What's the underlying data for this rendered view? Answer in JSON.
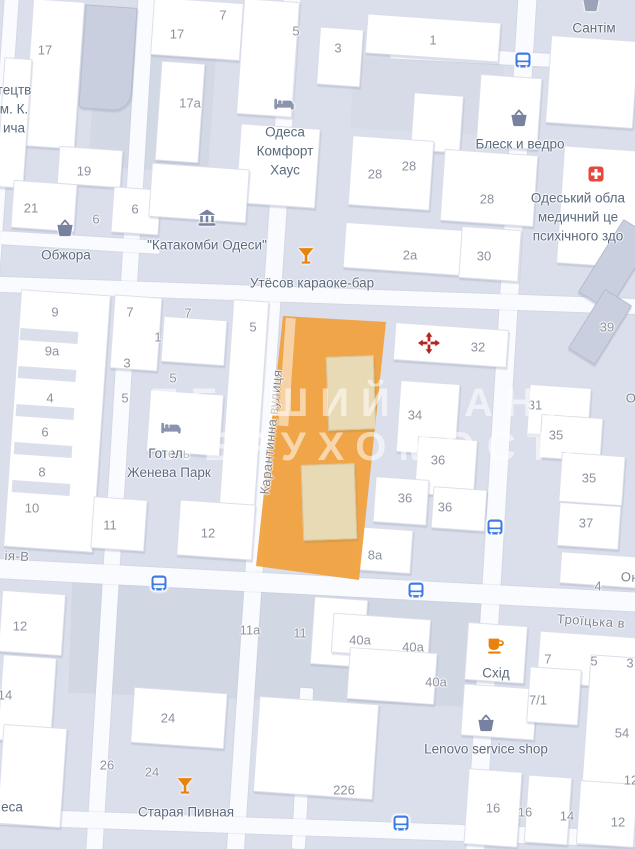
{
  "colors": {
    "selection_orange": "#F0A23E",
    "selection_building_beige": "#E9DAB6",
    "transit_blue": "#3D7BE5",
    "poi_orange": "#E8820C",
    "hospital_red": "#E5493D",
    "arrows_red": "#B3261E",
    "poi_slate": "#76829F",
    "road_white": "#FAFBFE",
    "block_gray": "#DBDFEB"
  },
  "watermark": {
    "line1": "ПЕРШИЙ БАНК",
    "line2": "НЕРУХОМОСТІ"
  },
  "map": {
    "street_labels": [
      {
        "text": "Карантинна вулиця",
        "x": 271,
        "y": 432,
        "rot": -84
      },
      {
        "text": "Троїцька в",
        "x": 591,
        "y": 621,
        "rot": 4
      },
      {
        "text": "ія-В",
        "x": 17,
        "y": 556,
        "rot": 3
      },
      {
        "text": "Он",
        "x": 630,
        "y": 577,
        "rot": 3
      },
      {
        "text": "О",
        "x": 631,
        "y": 398,
        "rot": 0
      }
    ],
    "poi_labels": [
      {
        "lines": [
          "Обжора"
        ],
        "x": 66,
        "y": 256
      },
      {
        "lines": [
          "\"Катакомби Одеси\""
        ],
        "x": 207,
        "y": 246
      },
      {
        "lines": [
          "Одеса",
          "Комфорт",
          "Хаус"
        ],
        "x": 285,
        "y": 152
      },
      {
        "lines": [
          "Утёсов караоке-бар"
        ],
        "x": 312,
        "y": 284
      },
      {
        "lines": [
          "Блеск и ведро"
        ],
        "x": 520,
        "y": 145
      },
      {
        "lines": [
          "Сантім"
        ],
        "x": 594,
        "y": 29
      },
      {
        "lines": [
          "Одеський обла",
          "медичний це",
          "психічного здо"
        ],
        "x": 578,
        "y": 218
      },
      {
        "lines": [
          "Готель",
          "Женева Парк"
        ],
        "x": 169,
        "y": 464
      },
      {
        "lines": [
          "Схід"
        ],
        "x": 496,
        "y": 674
      },
      {
        "lines": [
          "Lenovo service shop"
        ],
        "x": 486,
        "y": 750
      },
      {
        "lines": [
          "Старая Пивная"
        ],
        "x": 186,
        "y": 813
      },
      {
        "lines": [
          "тецтв",
          "м. К.",
          "ича"
        ],
        "x": 14,
        "y": 110
      },
      {
        "lines": [
          "еса"
        ],
        "x": 12,
        "y": 808
      }
    ],
    "numbers": [
      {
        "t": "17",
        "x": 45,
        "y": 50
      },
      {
        "t": "7",
        "x": 223,
        "y": 15
      },
      {
        "t": "17",
        "x": 177,
        "y": 34
      },
      {
        "t": "5",
        "x": 296,
        "y": 31
      },
      {
        "t": "3",
        "x": 338,
        "y": 48
      },
      {
        "t": "1",
        "x": 433,
        "y": 40
      },
      {
        "t": "17а",
        "x": 190,
        "y": 103
      },
      {
        "t": "19",
        "x": 84,
        "y": 171
      },
      {
        "t": "21",
        "x": 31,
        "y": 208
      },
      {
        "t": "6",
        "x": 135,
        "y": 209
      },
      {
        "t": "6",
        "x": 96,
        "y": 219
      },
      {
        "t": "28",
        "x": 409,
        "y": 166
      },
      {
        "t": "28",
        "x": 375,
        "y": 174
      },
      {
        "t": "28",
        "x": 487,
        "y": 199
      },
      {
        "t": "2а",
        "x": 410,
        "y": 255
      },
      {
        "t": "30",
        "x": 484,
        "y": 256
      },
      {
        "t": "9",
        "x": 55,
        "y": 312
      },
      {
        "t": "7",
        "x": 130,
        "y": 312
      },
      {
        "t": "7",
        "x": 188,
        "y": 313
      },
      {
        "t": "5",
        "x": 253,
        "y": 327
      },
      {
        "t": "1",
        "x": 158,
        "y": 337
      },
      {
        "t": "9а",
        "x": 52,
        "y": 351
      },
      {
        "t": "3",
        "x": 127,
        "y": 363
      },
      {
        "t": "5",
        "x": 173,
        "y": 378
      },
      {
        "t": "4",
        "x": 50,
        "y": 398
      },
      {
        "t": "5",
        "x": 125,
        "y": 398
      },
      {
        "t": "6",
        "x": 45,
        "y": 432
      },
      {
        "t": "8",
        "x": 42,
        "y": 472
      },
      {
        "t": "10",
        "x": 32,
        "y": 508
      },
      {
        "t": "11",
        "x": 110,
        "y": 525
      },
      {
        "t": "12",
        "x": 208,
        "y": 533
      },
      {
        "t": "32",
        "x": 478,
        "y": 347
      },
      {
        "t": "39",
        "x": 607,
        "y": 327
      },
      {
        "t": "31",
        "x": 535,
        "y": 405
      },
      {
        "t": "34",
        "x": 415,
        "y": 415
      },
      {
        "t": "35",
        "x": 556,
        "y": 435
      },
      {
        "t": "36",
        "x": 438,
        "y": 460
      },
      {
        "t": "35",
        "x": 589,
        "y": 478
      },
      {
        "t": "36",
        "x": 405,
        "y": 498
      },
      {
        "t": "36",
        "x": 445,
        "y": 507
      },
      {
        "t": "37",
        "x": 586,
        "y": 523
      },
      {
        "t": "8а",
        "x": 375,
        "y": 555
      },
      {
        "t": "4",
        "x": 598,
        "y": 586
      },
      {
        "t": "12",
        "x": 20,
        "y": 626
      },
      {
        "t": "11а",
        "x": 250,
        "y": 630
      },
      {
        "t": "11",
        "x": 300,
        "y": 633
      },
      {
        "t": "40а",
        "x": 360,
        "y": 640
      },
      {
        "t": "40а",
        "x": 413,
        "y": 647
      },
      {
        "t": "7",
        "x": 548,
        "y": 659
      },
      {
        "t": "5",
        "x": 594,
        "y": 661
      },
      {
        "t": "3",
        "x": 630,
        "y": 663
      },
      {
        "t": "40а",
        "x": 436,
        "y": 682
      },
      {
        "t": "14",
        "x": 5,
        "y": 695
      },
      {
        "t": "7/1",
        "x": 538,
        "y": 700
      },
      {
        "t": "24",
        "x": 168,
        "y": 718
      },
      {
        "t": "54",
        "x": 622,
        "y": 733
      },
      {
        "t": "26",
        "x": 107,
        "y": 765
      },
      {
        "t": "24",
        "x": 152,
        "y": 772
      },
      {
        "t": "12",
        "x": 631,
        "y": 780
      },
      {
        "t": "226",
        "x": 344,
        "y": 790
      },
      {
        "t": "16",
        "x": 493,
        "y": 808
      },
      {
        "t": "16",
        "x": 525,
        "y": 812
      },
      {
        "t": "14",
        "x": 567,
        "y": 816
      },
      {
        "t": "12",
        "x": 618,
        "y": 822
      }
    ],
    "icons": [
      {
        "type": "basket",
        "x": 65,
        "y": 228
      },
      {
        "type": "museum",
        "x": 207,
        "y": 218
      },
      {
        "type": "bed",
        "x": 284,
        "y": 104
      },
      {
        "type": "cocktail",
        "x": 306,
        "y": 256
      },
      {
        "type": "basket",
        "x": 519,
        "y": 118
      },
      {
        "type": "store",
        "x": 591,
        "y": 3
      },
      {
        "type": "bus",
        "x": 523,
        "y": 61
      },
      {
        "type": "hospital",
        "x": 596,
        "y": 174
      },
      {
        "type": "arrows",
        "x": 429,
        "y": 343
      },
      {
        "type": "bed",
        "x": 171,
        "y": 428
      },
      {
        "type": "bus",
        "x": 495,
        "y": 528
      },
      {
        "type": "bus",
        "x": 159,
        "y": 584
      },
      {
        "type": "bus",
        "x": 416,
        "y": 591
      },
      {
        "type": "coffee",
        "x": 496,
        "y": 646
      },
      {
        "type": "basket",
        "x": 486,
        "y": 723
      },
      {
        "type": "cocktail",
        "x": 185,
        "y": 786
      },
      {
        "type": "bus",
        "x": 401,
        "y": 824
      }
    ]
  }
}
